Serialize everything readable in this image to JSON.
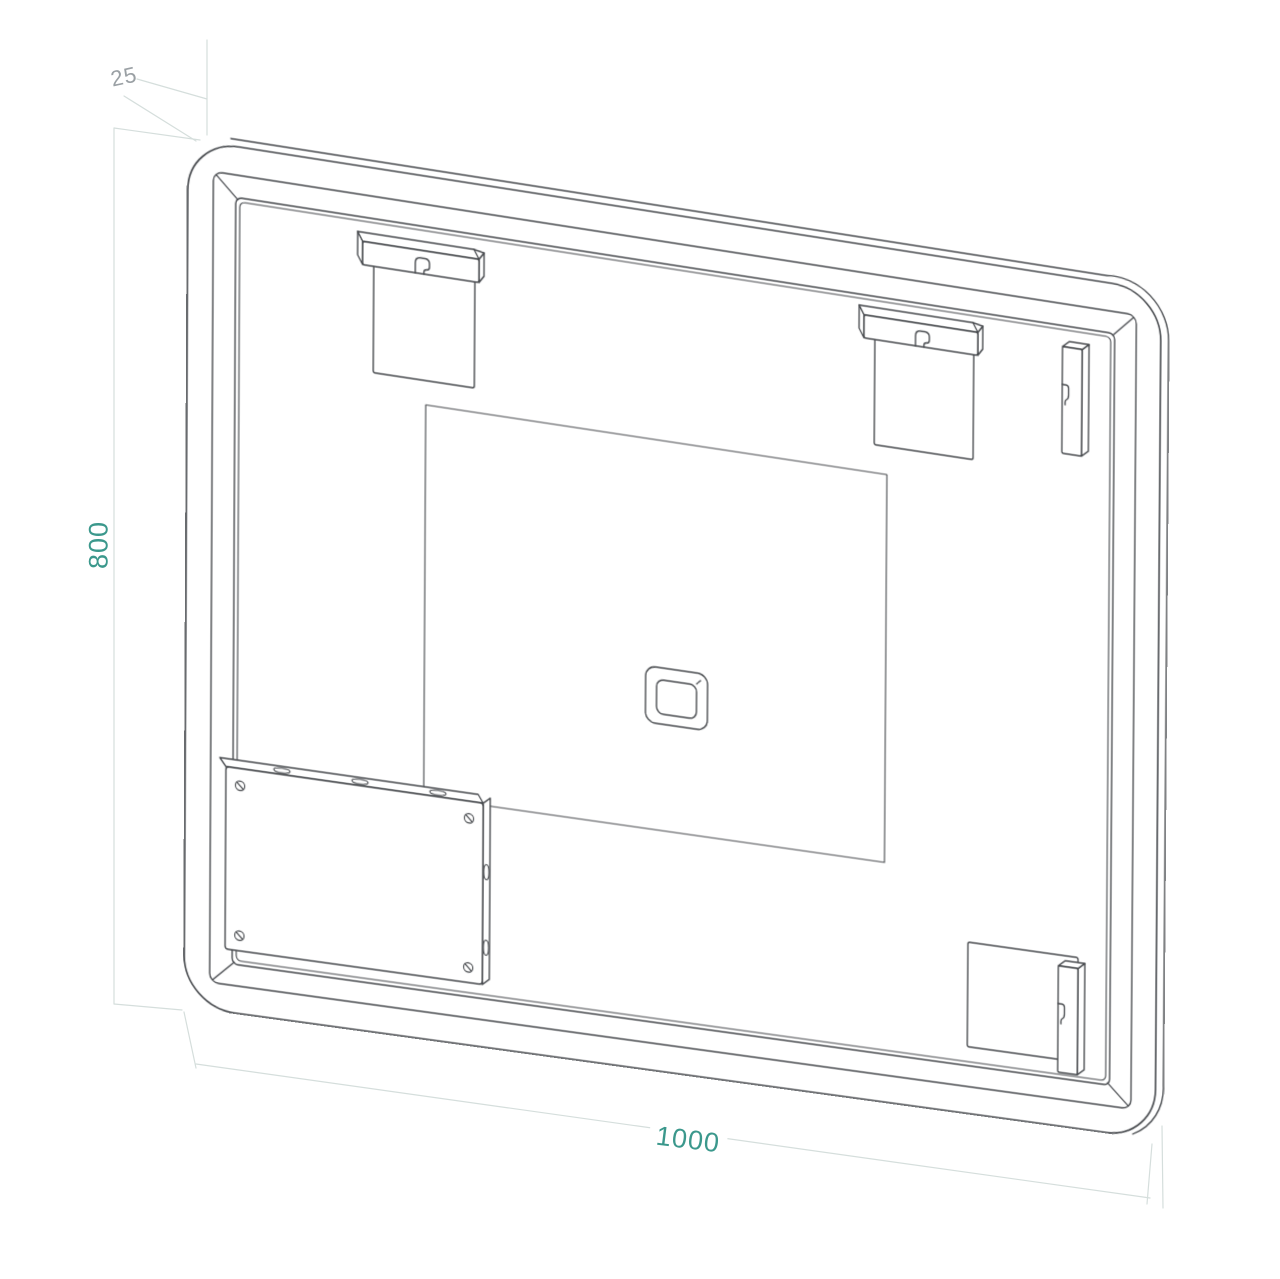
{
  "drawing": {
    "type": "technical-drawing",
    "dimension_labels": {
      "depth": "25",
      "height": "800",
      "width": "1000"
    },
    "colors": {
      "line": "#44474b",
      "constr": "#d5dedc",
      "dim": "#3b988c",
      "depth": "#9aa0a4",
      "bg": "#ffffff"
    }
  }
}
